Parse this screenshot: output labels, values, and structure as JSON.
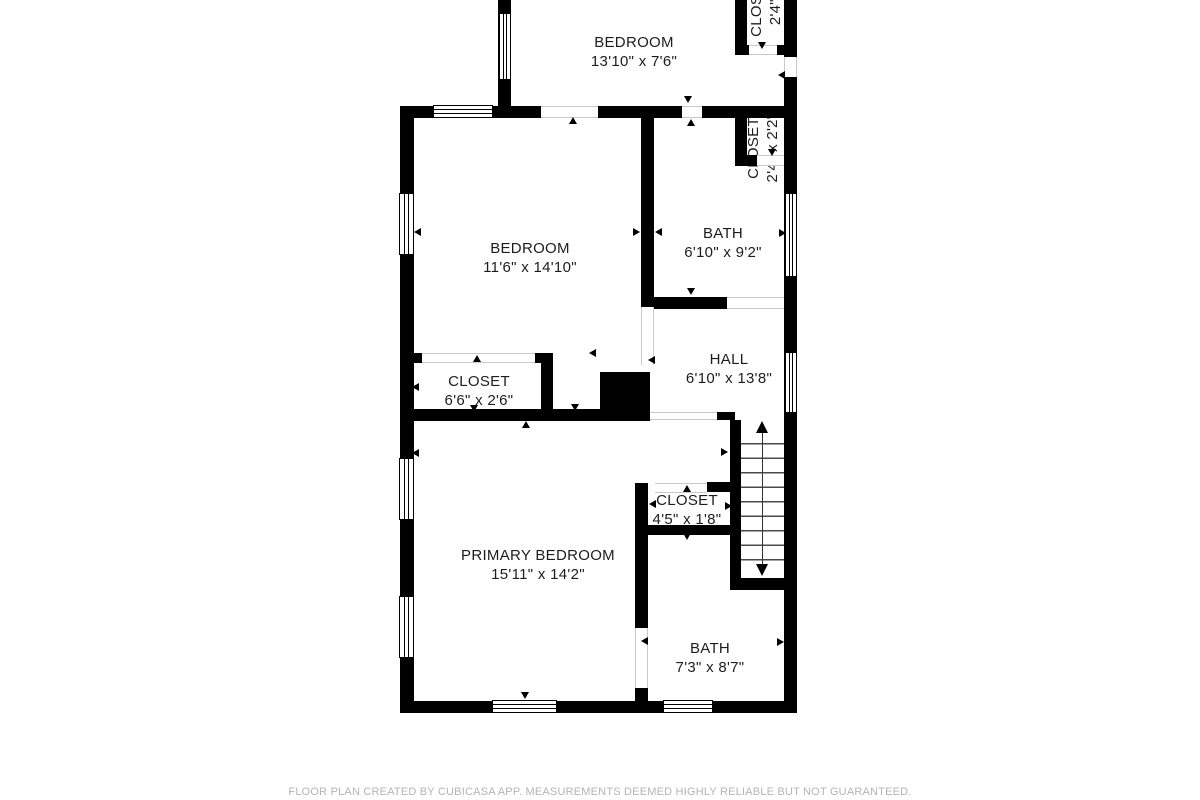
{
  "plan": {
    "rooms": [
      {
        "id": "bedroom-top",
        "name": "BEDROOM",
        "dims": "13'10\" x 7'6\""
      },
      {
        "id": "bedroom-mid",
        "name": "BEDROOM",
        "dims": "11'6\" x 14'10\""
      },
      {
        "id": "bath-mid",
        "name": "BATH",
        "dims": "6'10\" x 9'2\""
      },
      {
        "id": "closet-mid",
        "name": "CLOSET",
        "dims": "2'4\" x 2'2\""
      },
      {
        "id": "closet-top",
        "name": "CLOSET",
        "dims": "2'4\" x"
      },
      {
        "id": "hall",
        "name": "HALL",
        "dims": "6'10\" x 13'8\""
      },
      {
        "id": "closet-left",
        "name": "CLOSET",
        "dims": "6'6\" x 2'6\""
      },
      {
        "id": "primary-bedroom",
        "name": "PRIMARY BEDROOM",
        "dims": "15'11\" x 14'2\""
      },
      {
        "id": "closet-small",
        "name": "CLOSET",
        "dims": "4'5\" x 1'8\""
      },
      {
        "id": "bath-bottom",
        "name": "BATH",
        "dims": "7'3\" x 8'7\""
      }
    ],
    "stairs": {
      "direction": "up",
      "treads": 10
    },
    "colors": {
      "wall": "#000000",
      "label": "#1d1d1d",
      "muted": "#b4b4b4"
    },
    "footer": {
      "disclaimer": "FLOOR PLAN CREATED BY CUBICASA APP. MEASUREMENTS DEEMED HIGHLY RELIABLE BUT NOT GUARANTEED."
    }
  }
}
